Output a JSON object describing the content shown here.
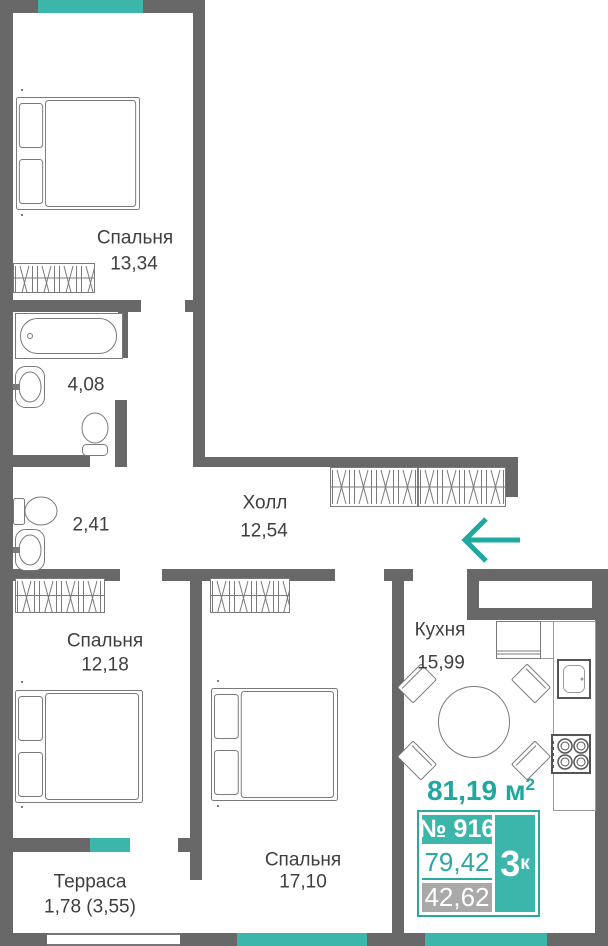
{
  "plan": {
    "rooms": {
      "bedroom1": {
        "label": "Спальня",
        "area": "13,34"
      },
      "bathroom": {
        "area": "4,08"
      },
      "wc": {
        "area": "2,41"
      },
      "hall": {
        "label": "Холл",
        "area": "12,54"
      },
      "bedroom2": {
        "label": "Спальня",
        "area": "12,18"
      },
      "bedroom3": {
        "label": "Спальня",
        "area": "17,10"
      },
      "kitchen": {
        "label": "Кухня",
        "area": "15,99"
      },
      "terrace": {
        "label": "Терраса",
        "area": "1,78 (3,55)"
      }
    },
    "total_area": {
      "value": "81,19 м",
      "sup": "2"
    },
    "unit_card": {
      "number": "№ 916",
      "rooms": "3",
      "rooms_sup": "к",
      "area_total": "79,42",
      "area_living": "42,62"
    },
    "entrance_arrow": "left",
    "colors": {
      "wall": "#686868",
      "accent": "#1ea89f",
      "accent_fill": "#3cb5ab",
      "muted_box": "#a9a9a9"
    }
  }
}
